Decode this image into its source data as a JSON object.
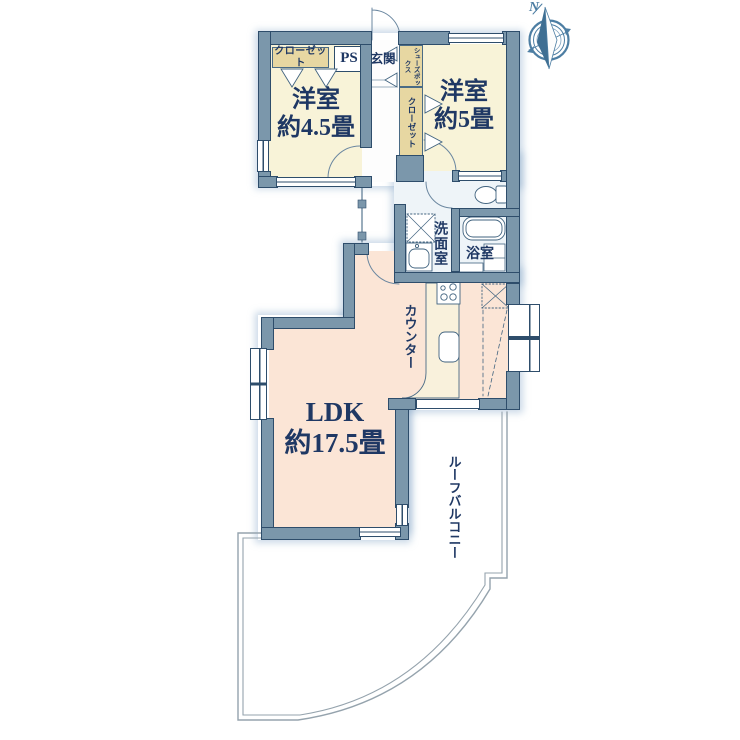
{
  "title": "floor-plan",
  "labels": {
    "bedroom1_name": "洋室",
    "bedroom1_size": "約4.5畳",
    "bedroom2_name": "洋室",
    "bedroom2_size": "約5畳",
    "ldk_name": "LDK",
    "ldk_size": "約17.5畳",
    "entrance": "玄関",
    "closet1": "クローゼット",
    "closet2": "クローゼット",
    "shoes_box": "シューズボックス",
    "pipe_space": "PS",
    "washroom": "洗面室",
    "bathroom": "浴室",
    "counter": "カウンター",
    "roof_balcony": "ルーフバルコニー",
    "compass_north": "N"
  },
  "colors": {
    "wall": "#7b97ab",
    "wall_border": "#2e4d6b",
    "room_cream": "#f8f3d8",
    "room_pink": "#fbe5d6",
    "closet_tan": "#e7d7a2",
    "sanitary": "#eef4f8",
    "text": "#1f3864",
    "compass": "#4d7ea3",
    "balcony_line": "#95a3ad",
    "counter_top": "#f9f1dc"
  }
}
